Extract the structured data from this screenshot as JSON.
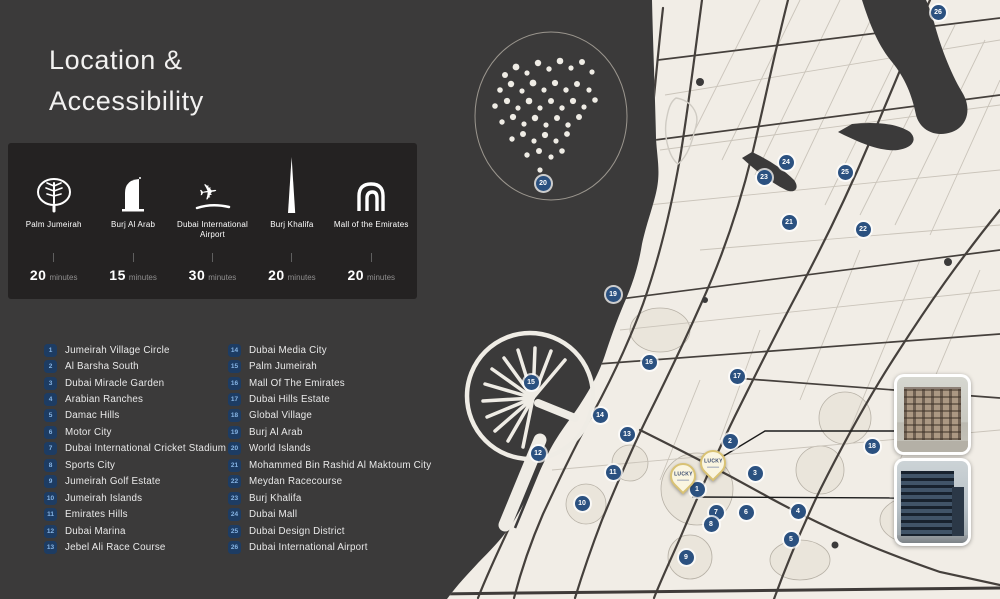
{
  "page": {
    "title_line1": "Location &",
    "title_line2": "Accessibility"
  },
  "landmarks_panel": {
    "items": [
      {
        "icon": "palm-jumeirah-icon",
        "label": "Palm Jumeirah",
        "time": "20",
        "unit": "minutes"
      },
      {
        "icon": "burj-al-arab-icon",
        "label": "Burj Al Arab",
        "time": "15",
        "unit": "minutes"
      },
      {
        "icon": "airport-icon",
        "label": "Dubai International Airport",
        "time": "30",
        "unit": "minutes"
      },
      {
        "icon": "burj-khalifa-icon",
        "label": "Burj Khalifa",
        "time": "20",
        "unit": "minutes"
      },
      {
        "icon": "mall-of-the-emirates-icon",
        "label": "Mall of the Emirates",
        "time": "20",
        "unit": "minutes"
      }
    ]
  },
  "locations": [
    {
      "num": 1,
      "name": "Jumeirah Village Circle"
    },
    {
      "num": 2,
      "name": "Al Barsha South"
    },
    {
      "num": 3,
      "name": "Dubai Miracle Garden"
    },
    {
      "num": 4,
      "name": "Arabian Ranches"
    },
    {
      "num": 5,
      "name": "Damac Hills"
    },
    {
      "num": 6,
      "name": "Motor City"
    },
    {
      "num": 7,
      "name": "Dubai International Cricket Stadium"
    },
    {
      "num": 8,
      "name": "Sports City"
    },
    {
      "num": 9,
      "name": "Jumeirah Golf Estate"
    },
    {
      "num": 10,
      "name": "Jumeirah Islands"
    },
    {
      "num": 11,
      "name": "Emirates Hills"
    },
    {
      "num": 12,
      "name": "Dubai Marina"
    },
    {
      "num": 13,
      "name": "Jebel Ali Race Course"
    },
    {
      "num": 14,
      "name": "Dubai Media City"
    },
    {
      "num": 15,
      "name": "Palm Jumeirah"
    },
    {
      "num": 16,
      "name": "Mall Of The Emirates"
    },
    {
      "num": 17,
      "name": "Dubai Hills Estate"
    },
    {
      "num": 18,
      "name": "Global Village"
    },
    {
      "num": 19,
      "name": "Burj Al Arab"
    },
    {
      "num": 20,
      "name": "World Islands"
    },
    {
      "num": 21,
      "name": "Mohammed Bin Rashid Al Maktoum City"
    },
    {
      "num": 22,
      "name": "Meydan Racecourse"
    },
    {
      "num": 23,
      "name": "Burj Khalifa"
    },
    {
      "num": 24,
      "name": "Dubai Mall"
    },
    {
      "num": 25,
      "name": "Dubai Design District"
    },
    {
      "num": 26,
      "name": "Dubai International Airport"
    }
  ],
  "map": {
    "markers": [
      {
        "num": 1,
        "x": 697,
        "y": 489
      },
      {
        "num": 2,
        "x": 730,
        "y": 441
      },
      {
        "num": 3,
        "x": 755,
        "y": 473
      },
      {
        "num": 4,
        "x": 798,
        "y": 511
      },
      {
        "num": 5,
        "x": 791,
        "y": 539
      },
      {
        "num": 6,
        "x": 746,
        "y": 512
      },
      {
        "num": 7,
        "x": 716,
        "y": 512
      },
      {
        "num": 8,
        "x": 711,
        "y": 524
      },
      {
        "num": 9,
        "x": 686,
        "y": 557
      },
      {
        "num": 10,
        "x": 582,
        "y": 503
      },
      {
        "num": 11,
        "x": 613,
        "y": 472
      },
      {
        "num": 12,
        "x": 538,
        "y": 453
      },
      {
        "num": 13,
        "x": 627,
        "y": 434
      },
      {
        "num": 14,
        "x": 600,
        "y": 415
      },
      {
        "num": 15,
        "x": 531,
        "y": 382
      },
      {
        "num": 16,
        "x": 649,
        "y": 362
      },
      {
        "num": 17,
        "x": 737,
        "y": 376
      },
      {
        "num": 18,
        "x": 872,
        "y": 446
      },
      {
        "num": 19,
        "x": 613,
        "y": 294
      },
      {
        "num": 20,
        "x": 543,
        "y": 183
      },
      {
        "num": 21,
        "x": 789,
        "y": 222
      },
      {
        "num": 22,
        "x": 863,
        "y": 229
      },
      {
        "num": 23,
        "x": 764,
        "y": 177
      },
      {
        "num": 24,
        "x": 786,
        "y": 162
      },
      {
        "num": 25,
        "x": 845,
        "y": 172
      },
      {
        "num": 26,
        "x": 938,
        "y": 12
      }
    ],
    "pins": [
      {
        "label": "LUCKY",
        "x": 683,
        "y": 476
      },
      {
        "label": "LUCKY",
        "x": 713,
        "y": 463
      }
    ]
  },
  "colors": {
    "background": "#3b3a3a",
    "panel": "#242222",
    "land": "#f1ede6",
    "marker_blue": "#2b5180",
    "badge_blue": "#1d3c63",
    "pin_fill": "#faf5e0",
    "pin_border": "#d9c274"
  }
}
